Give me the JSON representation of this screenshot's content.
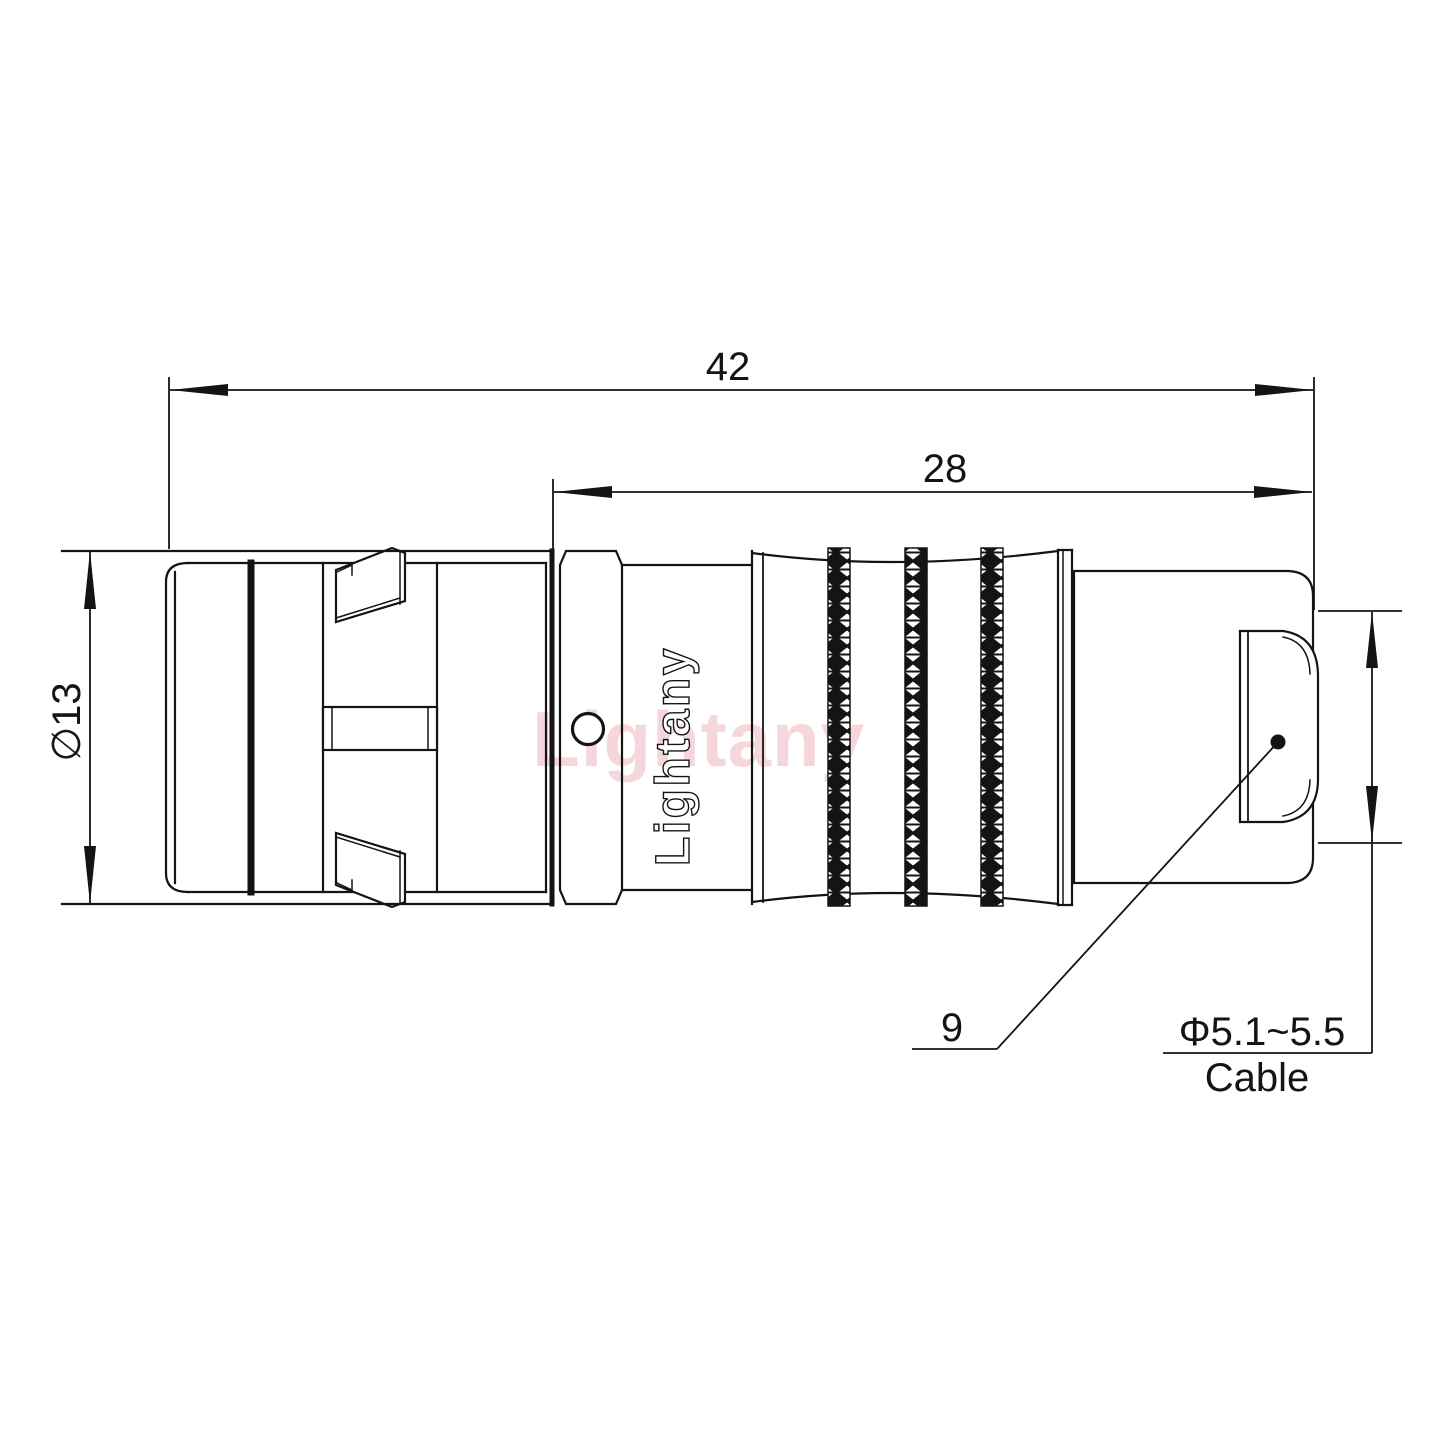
{
  "drawing": {
    "type": "connector-technical-drawing",
    "watermark_text": "Lightany",
    "engraving_text": "Lightany",
    "dimensions": {
      "overall_length": "42",
      "rear_section_length": "28",
      "body_diameter": "∅13",
      "rear_nut_size": "9",
      "cable_range": "Φ5.1~5.5",
      "cable_label": "Cable"
    },
    "colors": {
      "line": "#141414",
      "watermark_pink": "#edafb7",
      "background": "#ffffff"
    }
  }
}
